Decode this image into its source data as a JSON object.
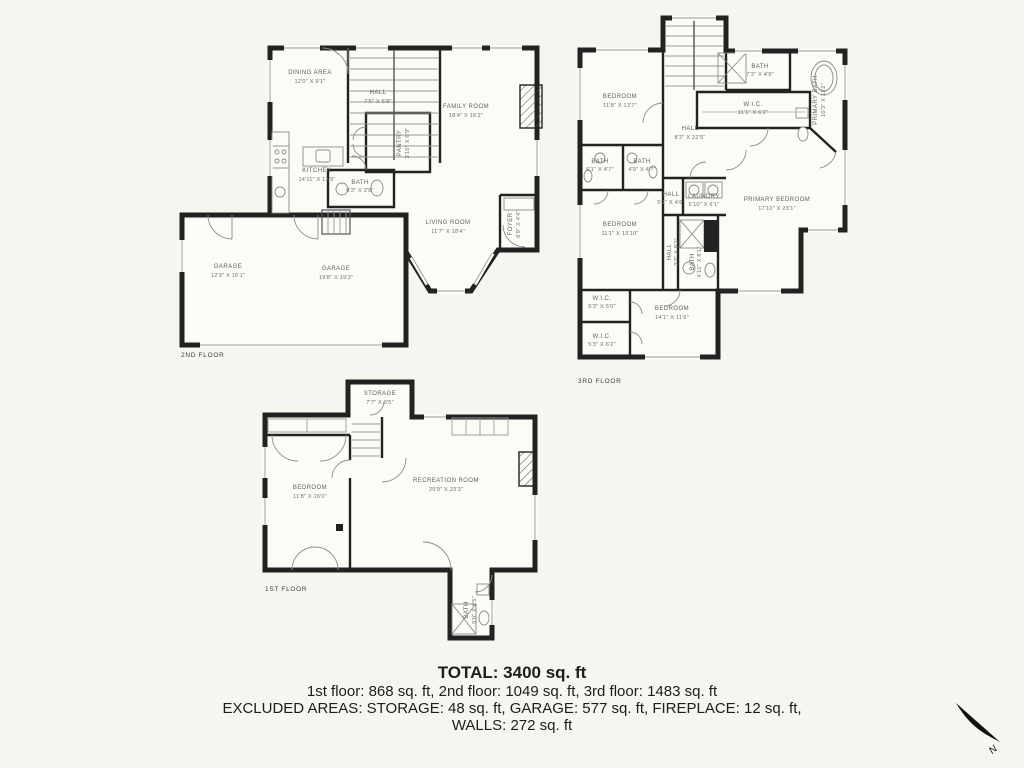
{
  "floors": {
    "second": {
      "label": "2ND FLOOR",
      "rooms": {
        "dining": {
          "name": "DINING AREA",
          "dims": "12'0\" X 9'1\""
        },
        "hall": {
          "name": "HALL",
          "dims": "7'5\" X 5'8\""
        },
        "family": {
          "name": "FAMILY ROOM",
          "dims": "18'4\" X 16'2\""
        },
        "pantry": {
          "name": "PANTRY",
          "dims": "3'10\" X 6'9\""
        },
        "kitchen": {
          "name": "KITCHEN",
          "dims": "14'11\" X 13'9\""
        },
        "bath": {
          "name": "BATH",
          "dims": "8'3\" X 2'8\""
        },
        "living": {
          "name": "LIVING ROOM",
          "dims": "11'7\" X 18'4\""
        },
        "foyer": {
          "name": "FOYER",
          "dims": "6'9\" X 4'4\""
        },
        "garage_small": {
          "name": "GARAGE",
          "dims": "12'3\" X 16'1\""
        },
        "garage_large": {
          "name": "GARAGE",
          "dims": "19'8\" X 19'3\""
        }
      }
    },
    "third": {
      "label": "3RD FLOOR",
      "rooms": {
        "bedroom_nw": {
          "name": "BEDROOM",
          "dims": "11'8\" X 13'7\""
        },
        "bath_top": {
          "name": "BATH",
          "dims": "7'3\" X 4'9\""
        },
        "wic_top": {
          "name": "W.I.C.",
          "dims": "11'1\" X 6'2\""
        },
        "primary_bath": {
          "name": "PRIMARY BATH",
          "dims": "10'3\" X 11'2\""
        },
        "hall_main": {
          "name": "HALL",
          "dims": "8'2\" X 22'5\""
        },
        "bath_left1": {
          "name": "BATH",
          "dims": "6'1\" X 4'7\""
        },
        "bath_left2": {
          "name": "BATH",
          "dims": "4'9\" X 4'7\""
        },
        "hall_small": {
          "name": "HALL",
          "dims": "5'1\" X 4'6\""
        },
        "laundry": {
          "name": "LAUNDRY",
          "dims": "5'10\" X 6'1\""
        },
        "primary_bedroom": {
          "name": "PRIMARY BEDROOM",
          "dims": "17'10\" X 23'1\""
        },
        "bedroom_w": {
          "name": "BEDROOM",
          "dims": "11'1\" X 13'10\""
        },
        "hall_v": {
          "name": "HALL",
          "dims": "3'7\" X 8'2\""
        },
        "bath_v": {
          "name": "BATH",
          "dims": "4'10\" X 8'1\""
        },
        "wic_1": {
          "name": "W.I.C.",
          "dims": "5'3\" X 5'0\""
        },
        "wic_2": {
          "name": "W.I.C.",
          "dims": "5'3\" X 6'2\""
        },
        "bedroom_s": {
          "name": "BEDROOM",
          "dims": "14'1\" X 11'6\""
        }
      }
    },
    "first": {
      "label": "1ST FLOOR",
      "rooms": {
        "storage": {
          "name": "STORAGE",
          "dims": "7'7\" X 9'5\""
        },
        "bedroom": {
          "name": "BEDROOM",
          "dims": "11'8\" X 16'0\""
        },
        "recreation": {
          "name": "RECREATION ROOM",
          "dims": "25'9\" X 23'3\""
        },
        "bath": {
          "name": "BATH",
          "dims": "5'0\" X 8'5\""
        }
      }
    }
  },
  "summary": {
    "total": "TOTAL: 3400 sq. ft",
    "floors_line": "1st floor: 868 sq. ft, 2nd floor: 1049 sq. ft, 3rd floor: 1483 sq. ft",
    "excluded_line": "EXCLUDED AREAS: STORAGE: 48 sq. ft, GARAGE: 577 sq. ft, FIREPLACE: 12 sq. ft,",
    "walls_line": "WALLS: 272 sq. ft"
  },
  "compass": {
    "north_label": "N"
  },
  "colors": {
    "background": "#F6F5EF",
    "wall": "#222222",
    "floor": "#FCFBF6",
    "label": "#5f5f5f"
  }
}
